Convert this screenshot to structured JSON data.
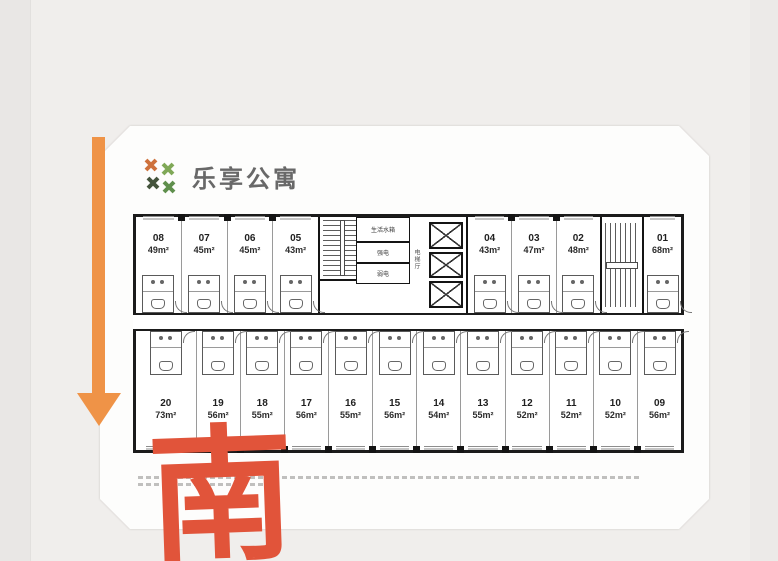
{
  "brand": {
    "name": "乐享公寓"
  },
  "compass": {
    "south_label": "南",
    "arrow_direction": "down"
  },
  "floorplan": {
    "top_left_units": [
      {
        "no": "08",
        "area": "49m²"
      },
      {
        "no": "07",
        "area": "45m²"
      },
      {
        "no": "06",
        "area": "45m²"
      },
      {
        "no": "05",
        "area": "43m²"
      }
    ],
    "top_right_units": [
      {
        "no": "04",
        "area": "43m²"
      },
      {
        "no": "03",
        "area": "47m²"
      },
      {
        "no": "02",
        "area": "48m²"
      },
      {
        "no": "01",
        "area": "68m²"
      }
    ],
    "bottom_units": [
      {
        "no": "20",
        "area": "73m²"
      },
      {
        "no": "19",
        "area": "56m²"
      },
      {
        "no": "18",
        "area": "55m²"
      },
      {
        "no": "17",
        "area": "56m²"
      },
      {
        "no": "16",
        "area": "55m²"
      },
      {
        "no": "15",
        "area": "56m²"
      },
      {
        "no": "14",
        "area": "54m²"
      },
      {
        "no": "13",
        "area": "55m²"
      },
      {
        "no": "12",
        "area": "52m²"
      },
      {
        "no": "11",
        "area": "52m²"
      },
      {
        "no": "10",
        "area": "52m²"
      },
      {
        "no": "09",
        "area": "56m²"
      }
    ],
    "core": {
      "water_room": "生活水箱",
      "strong_power": "强电",
      "weak_power": "弱电",
      "elevator_hall": "电梯厅"
    }
  },
  "colors": {
    "arrow": "#EF9347",
    "south": "#E1543A",
    "logo_orange": "#CE713C",
    "logo_green": "#7FA857",
    "logo_green2": "#5F8F4C",
    "logo_dark": "#44543C"
  }
}
